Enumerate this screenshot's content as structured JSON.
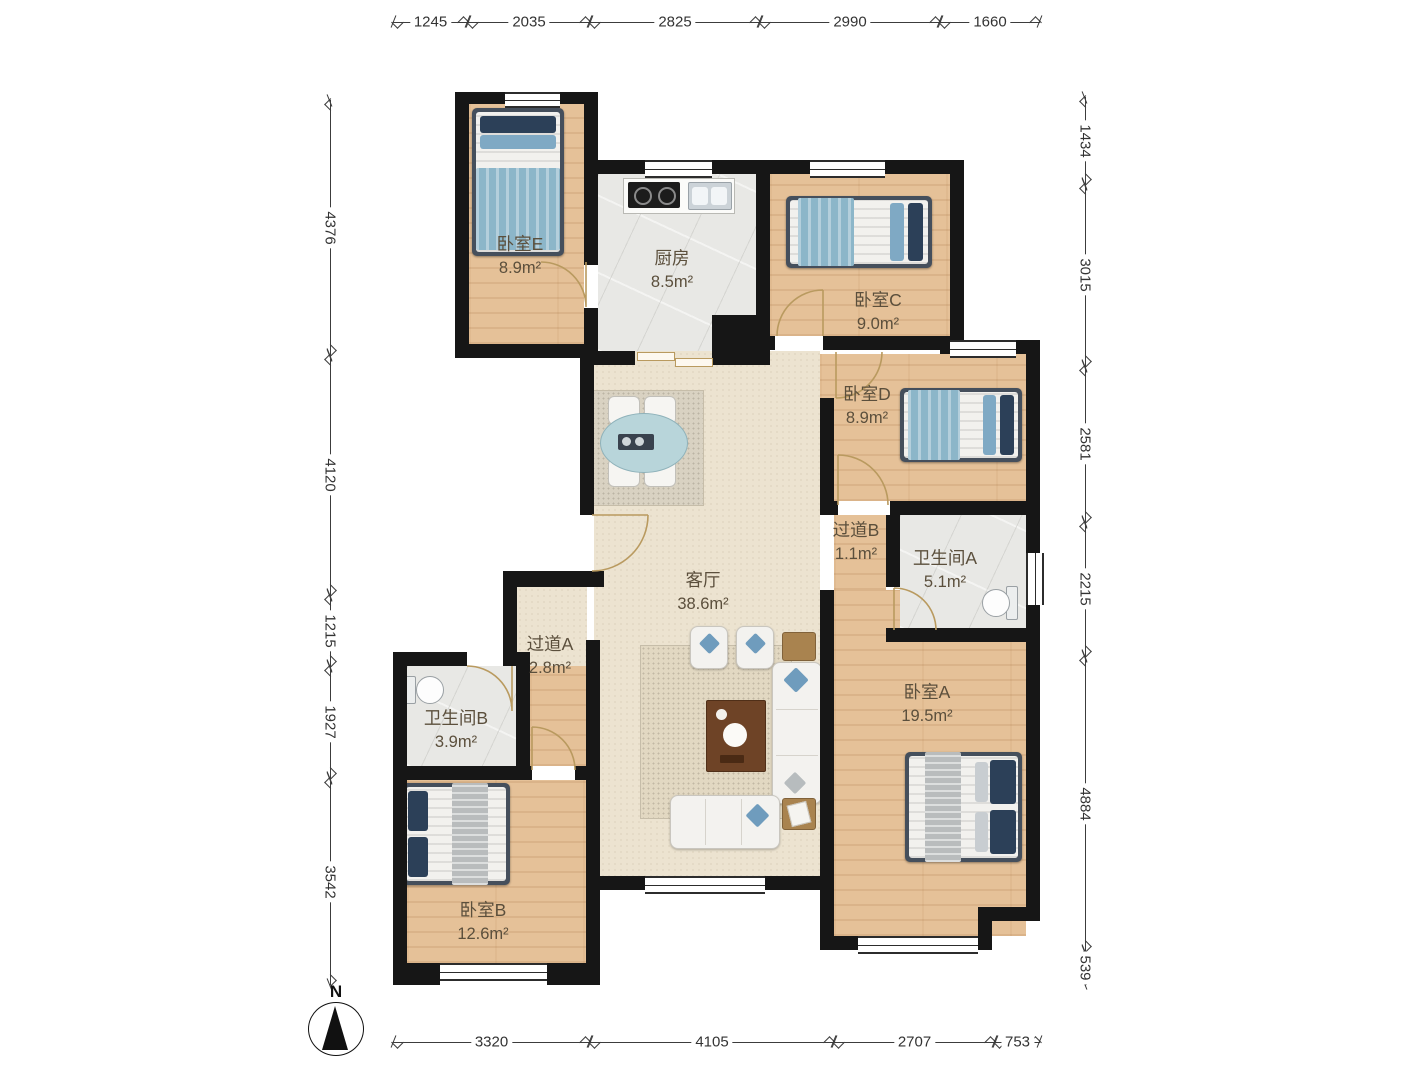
{
  "rooms": {
    "bedroomE": {
      "label": "卧室E",
      "area": "8.9m²"
    },
    "kitchen": {
      "label": "厨房",
      "area": "8.5m²"
    },
    "bedroomC": {
      "label": "卧室C",
      "area": "9.0m²"
    },
    "bedroomD": {
      "label": "卧室D",
      "area": "8.9m²"
    },
    "hallwayB": {
      "label": "过道B",
      "area": "1.1m²"
    },
    "bathroomA": {
      "label": "卫生间A",
      "area": "5.1m²"
    },
    "living": {
      "label": "客厅",
      "area": "38.6m²"
    },
    "hallwayA": {
      "label": "过道A",
      "area": "2.8m²"
    },
    "bathroomB": {
      "label": "卫生间B",
      "area": "3.9m²"
    },
    "bedroomA": {
      "label": "卧室A",
      "area": "19.5m²"
    },
    "bedroomB": {
      "label": "卧室B",
      "area": "12.6m²"
    }
  },
  "dimensions": {
    "top": [
      "1245",
      "2035",
      "2825",
      "2990",
      "1660"
    ],
    "left": [
      "4376",
      "4120",
      "1215",
      "1927",
      "3542"
    ],
    "right": [
      "1434",
      "3015",
      "2581",
      "2215",
      "4884",
      "539"
    ],
    "bottom": [
      "3320",
      "4105",
      "2707",
      "753"
    ]
  },
  "compass": {
    "north_label": "N"
  },
  "colors": {
    "wall": "#161616",
    "wood": "#e5c198",
    "tile": "#e8e8e5",
    "living": "#ece3d0",
    "door": "#b99a5f"
  }
}
